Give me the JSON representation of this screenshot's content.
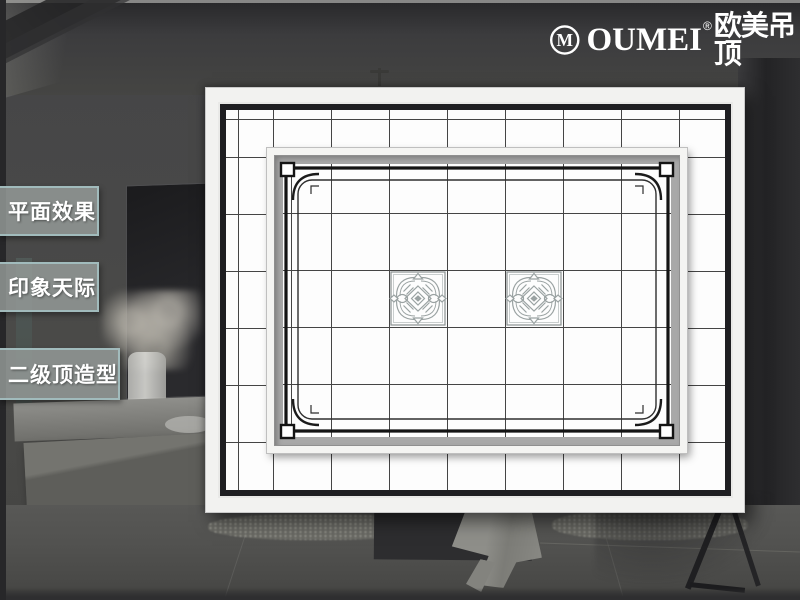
{
  "slide": {
    "width": 800,
    "height": 600,
    "kind": "product showcase slide"
  },
  "logo": {
    "mark": "M",
    "brand": "OUMEI",
    "registered": "®",
    "chinese": "欧美吊顶",
    "color": "#ffffff"
  },
  "nav": {
    "items": [
      {
        "id": "plan-effect",
        "label": "平面效果"
      },
      {
        "id": "impression-sky",
        "label": "印象天际"
      },
      {
        "id": "secondary-ceiling",
        "label": "二级顶造型"
      }
    ],
    "style": {
      "bg": "#969c9a",
      "border": "#a4c0c1",
      "text": "#ffffff"
    }
  },
  "ceiling_plan": {
    "type": "integrated-ceiling layout drawing (top view)",
    "outer_frame_color": "#1f1f22",
    "grid_line_color": "#454545",
    "tile_color": "#fdfdfd",
    "grid": {
      "columns": 9,
      "rows": 7,
      "cell_px": 58
    },
    "recessed_panel": {
      "present": true,
      "shadow_band_color": "#a8a8a8",
      "decorative_border": "black double-line frame, hollow corner squares, rounded inner corners",
      "patterned_tiles": {
        "count": 2,
        "position": "middle row, columns 4 and 6 of recessed panel",
        "pattern": "traditional spiral knot motif",
        "color": "#9aa2a2"
      }
    }
  },
  "background": {
    "description": "darkened living-room photograph (TV wall, flowers, cabinet, rug, draped cloth, chair)",
    "base_color": "#454545",
    "right_wall_color": "#232325"
  }
}
